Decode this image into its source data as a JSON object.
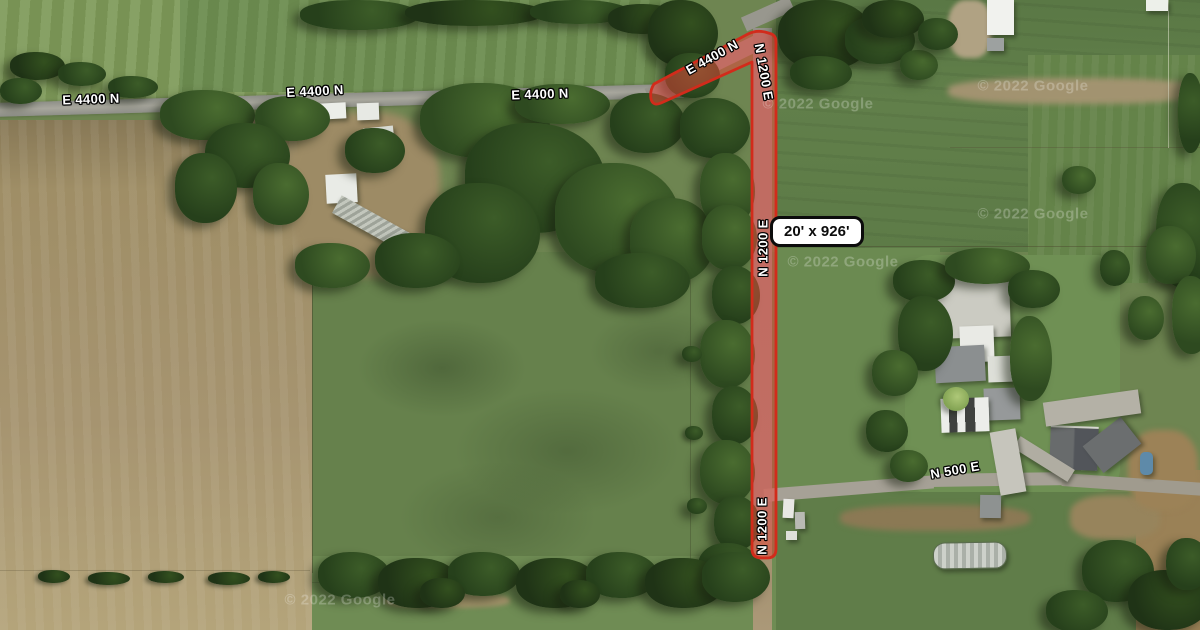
{
  "map": {
    "view": "satellite",
    "roads": {
      "e4400n": {
        "label": "E 4400 N"
      },
      "n1200e": {
        "label": "N 1200 E"
      },
      "n500e": {
        "label": "N 500 E"
      }
    },
    "annotation": {
      "measurement": "20' x 926'",
      "stroke_color": "#d22b1b",
      "fill_color": "rgba(236,70,58,0.5)"
    },
    "watermark": {
      "text": "© 2022 Google"
    }
  }
}
